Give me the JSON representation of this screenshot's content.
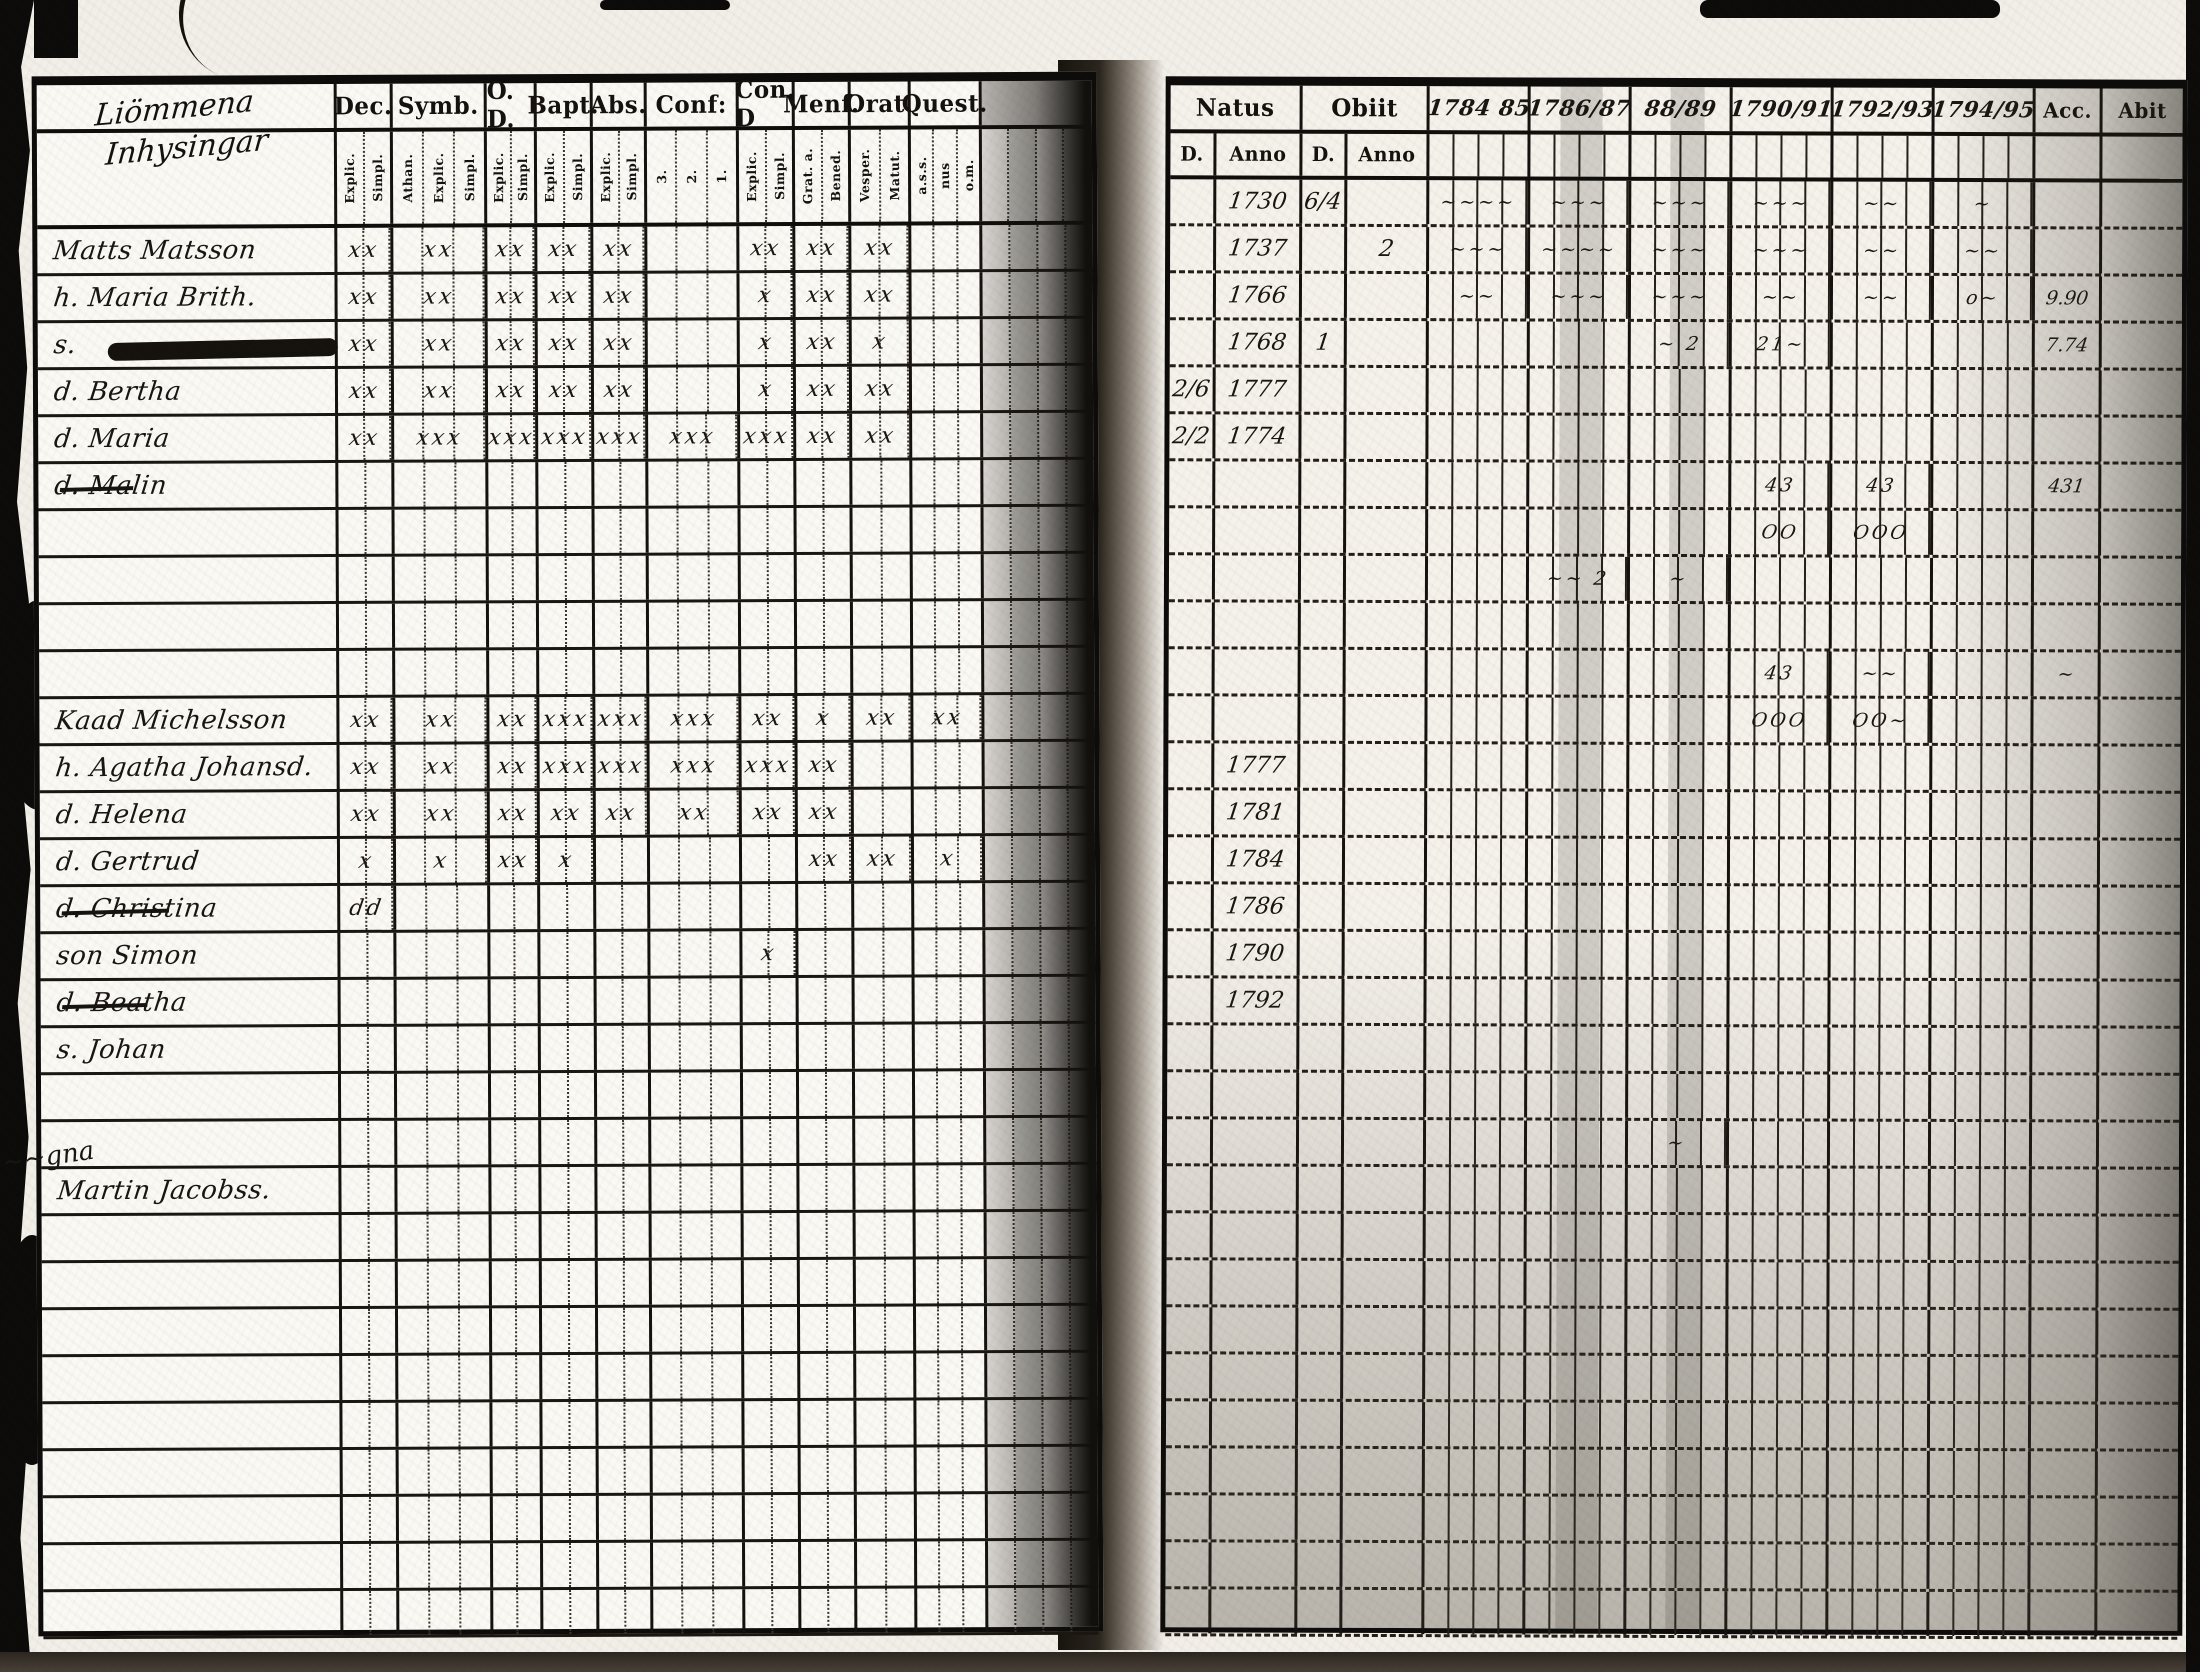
{
  "left_page": {
    "heading": {
      "line1": "Liömmena",
      "line2": "Inhysingar"
    },
    "columns": [
      {
        "label": "Dec.",
        "subs": [
          "Explic.",
          "Simpl."
        ]
      },
      {
        "label": "Symb.",
        "subs": [
          "Athan.",
          "Explic.",
          "Simpl."
        ]
      },
      {
        "label": "O. D.",
        "subs": [
          "Explic.",
          "Simpl."
        ]
      },
      {
        "label": "Bapt.",
        "subs": [
          "Explic.",
          "Simpl."
        ]
      },
      {
        "label": "Abs.",
        "subs": [
          "Explic.",
          "Simpl."
        ]
      },
      {
        "label": "Conf:",
        "subs": [
          "3.",
          "2.",
          "1."
        ]
      },
      {
        "label": "Con. D",
        "subs": [
          "Explic.",
          "Simpl."
        ]
      },
      {
        "label": "Menf.",
        "subs": [
          "Grat. a.",
          "Bened."
        ]
      },
      {
        "label": "Orat.",
        "subs": [
          "Vesper.",
          "Matut."
        ]
      },
      {
        "label": "Quest.",
        "subs": [
          "a.s.s.",
          "nus",
          "o.m."
        ]
      }
    ],
    "rows": [
      {
        "name": "Matts Matsson",
        "marks": [
          "xx",
          "xx",
          "xx",
          "xx",
          "xx",
          "",
          "xx",
          "xx",
          "xx",
          ""
        ]
      },
      {
        "name": "h. Maria Brith.",
        "marks": [
          "xx",
          "xx",
          "xx",
          "xx",
          "xx",
          "",
          "x",
          "xx",
          "xx",
          ""
        ]
      },
      {
        "name": "s.",
        "blot": true,
        "marks": [
          "xx",
          "xx",
          "xx",
          "xx",
          "xx",
          "",
          "x",
          "xx",
          "x",
          ""
        ]
      },
      {
        "name": "d. Bertha",
        "marks": [
          "xx",
          "xx",
          "xx",
          "xx",
          "xx",
          "",
          "x",
          "xx",
          "xx",
          ""
        ]
      },
      {
        "name": "d. Maria",
        "marks": [
          "xx",
          "xxx",
          "xxx",
          "xxx",
          "xxx",
          "xxx",
          "xxx",
          "xx",
          "xx",
          ""
        ]
      },
      {
        "name": "d. Malin",
        "struck": true,
        "marks": [
          "",
          "",
          "",
          "",
          "",
          "",
          "",
          "",
          "",
          ""
        ]
      },
      {},
      {},
      {},
      {},
      {
        "name": "Kaad Michelsson",
        "marks": [
          "xx",
          "xx",
          "xx",
          "xxx",
          "xxx",
          "xxx",
          "xx",
          "x",
          "xx",
          "xx"
        ]
      },
      {
        "name": "h. Agatha Johansd.",
        "marks": [
          "xx",
          "xx",
          "xx",
          "xxx",
          "xxx",
          "xxx",
          "xxx",
          "xx",
          "",
          ""
        ]
      },
      {
        "name": "d. Helena",
        "marks": [
          "xx",
          "xx",
          "xx",
          "xx",
          "xx",
          "xx",
          "xx",
          "xx",
          "",
          ""
        ]
      },
      {
        "name": "d. Gertrud",
        "marks": [
          "x",
          "x",
          "xx",
          "x",
          "",
          "",
          "",
          "xx",
          "xx",
          "x"
        ]
      },
      {
        "name": "d. Christina",
        "struck": true,
        "marks": [
          "dd",
          "",
          "",
          "",
          "",
          "",
          "",
          "",
          "",
          ""
        ]
      },
      {
        "name": "son Simon",
        "marks": [
          "",
          "",
          "",
          "",
          "",
          "",
          "x",
          "",
          "",
          ""
        ]
      },
      {
        "name": "d. Beatha",
        "struck": true,
        "marks": [
          "",
          "",
          "",
          "",
          "",
          "",
          "",
          "",
          "",
          ""
        ]
      },
      {
        "name": "s. Johan",
        "marks": [
          "",
          "",
          "",
          "",
          "",
          "",
          "",
          "",
          "",
          ""
        ]
      },
      {},
      {},
      {
        "name": "Martin Jacobss.",
        "marks": [
          "",
          "",
          "",
          "",
          "",
          "",
          "",
          "",
          "",
          ""
        ]
      },
      {},
      {},
      {},
      {},
      {},
      {},
      {},
      {},
      {}
    ]
  },
  "right_page": {
    "natus": {
      "label": "Natus",
      "subs": [
        "D.",
        "Anno"
      ]
    },
    "obiit": {
      "label": "Obiit",
      "subs": [
        "D.",
        "Anno"
      ]
    },
    "years": [
      "1784 85",
      "1786/87",
      "88/89",
      "1790/91",
      "1792/93",
      "1794/95"
    ],
    "acc_label": "Acc.",
    "abit_label": "Abit",
    "rows": [
      {
        "na": "1730",
        "od": "6/4",
        "y": [
          "∼∼∼∼",
          "∼∼∼",
          "∼∼∼",
          "∼∼∼",
          "∼∼",
          "∼"
        ]
      },
      {
        "na": "1737",
        "oa": "2",
        "y": [
          "∼∼∼",
          "∼∼∼∼",
          "∼∼∼",
          "∼∼∼",
          "∼∼",
          "∼∼"
        ]
      },
      {
        "na": "1766",
        "y": [
          "∼∼",
          "∼∼∼",
          "∼∼∼",
          "∼∼",
          "∼∼",
          "o∼"
        ],
        "acc": "9.90"
      },
      {
        "na": "1768",
        "od": "1",
        "y": [
          "",
          "",
          "∼ 2",
          "21∼",
          "",
          ""
        ],
        "acc": "7.74"
      },
      {
        "nd": "2/6",
        "na": "1777",
        "y": [
          "",
          "",
          "",
          "",
          "",
          ""
        ]
      },
      {
        "nd": "2/2",
        "na": "1774",
        "y": [
          "",
          "",
          "",
          "",
          "",
          ""
        ]
      },
      {
        "y": [
          "",
          "",
          "",
          "43",
          "43",
          ""
        ],
        "acc": "431"
      },
      {
        "y": [
          "",
          "",
          "",
          "OO",
          "OOO",
          ""
        ]
      },
      {
        "y": [
          "",
          "∼∼ 2",
          "∼",
          "",
          "",
          ""
        ]
      },
      {},
      {
        "y": [
          "",
          "",
          "",
          "43",
          "∼∼",
          ""
        ],
        "acc": "∼"
      },
      {
        "y": [
          "",
          "",
          "",
          "OOO",
          "OO∼",
          ""
        ]
      },
      {
        "na": "1777"
      },
      {
        "na": "1781"
      },
      {
        "na": "1784"
      },
      {
        "na": "1786"
      },
      {
        "na": "1790"
      },
      {
        "na": "1792"
      },
      {},
      {},
      {
        "y": [
          "",
          "",
          "∼",
          "",
          "",
          ""
        ]
      },
      {},
      {},
      {},
      {},
      {},
      {},
      {},
      {},
      {},
      {}
    ]
  },
  "margin_scribble": "∼∼gna"
}
